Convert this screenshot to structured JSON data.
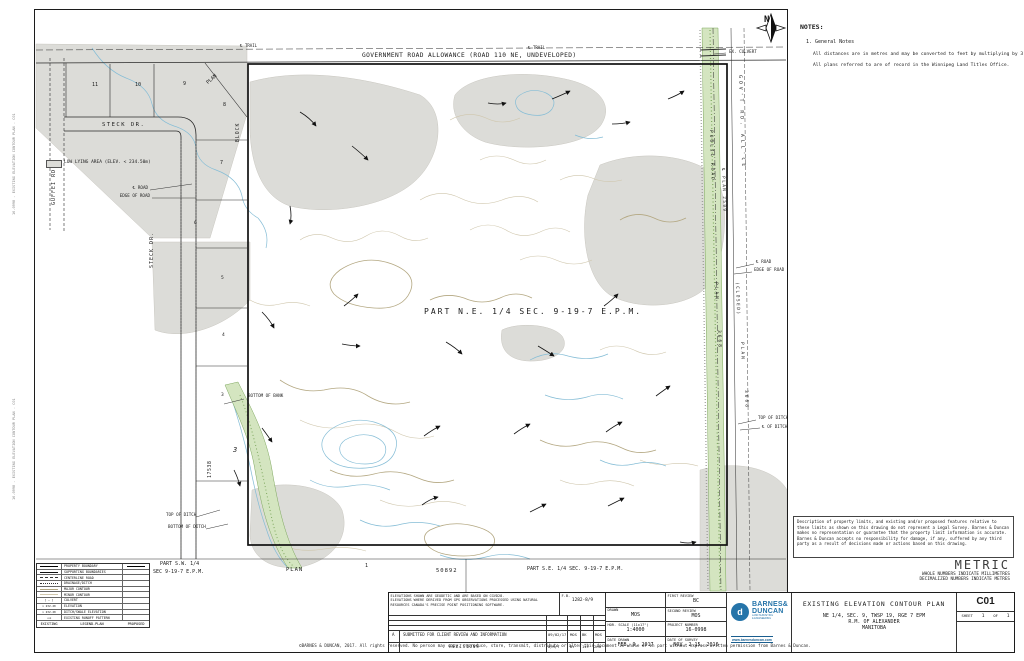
{
  "colors": {
    "contour_major": "#b3a781",
    "contour_minor": "#cfc6ac",
    "water": "#85bdd6",
    "vegetation_fill": "#d4e5c0",
    "vegetation_stroke": "#7da75d",
    "low_lying_fill": "#dcdcd8",
    "logo_blue": "#2574a9"
  },
  "side_stamp": "16-0998 - EXISTING ELEVATION CONTOUR PLAN - C01",
  "notes_panel": {
    "heading": "NOTES:",
    "item1": "1.  General Notes",
    "line1": "All distances are in metres and may be converted to feet by multiplying by 3.28084.",
    "line2": "All plans referred to are of record in the Winnipeg Land Titles Office."
  },
  "map": {
    "top": {
      "trail1": "℄ TRAIL",
      "trail2": "℄ TRAIL",
      "road_allowance": "GOVERNMENT ROAD ALLOWANCE (ROAD 110 NE, UNDEVELOPED)",
      "ex_culvert": "EX. CULVERT",
      "north": "N"
    },
    "subdivision": {
      "guffei_rd": "GUFFEI RD.",
      "steck_dr_h": "STECK DR.",
      "steck_dr_v": "STECK DR.",
      "plan_diag": "PLAN",
      "block": "BLOCK",
      "block_no": "3",
      "plan_17538": "17538",
      "lots_top": [
        "11",
        "10",
        "9",
        "8",
        "7"
      ],
      "lots_left": [
        "6",
        "5",
        "4",
        "3"
      ],
      "low_lying_label": "LOW LYING AREA (ELEV. < 234.50m)"
    },
    "callouts": {
      "cl_road_l": "℄ ROAD",
      "edge_of_road_l": "EDGE OF ROAD",
      "cl_road_r": "℄ ROAD",
      "edge_of_road_r": "EDGE OF ROAD",
      "bottom_of_bank": "BOTTOM OF BANK",
      "top_of_ditch_l": "TOP OF DITCH",
      "bottom_of_ditch_l": "BOTTOM OF DITCH",
      "top_of_ditch_r": "TOP OF DITCH",
      "cl_of_ditch_r": "℄ OF DITCH"
    },
    "parcel_label": "PART  N.E.  1/4  SEC.  9-19-7  E.P.M.",
    "corridor": {
      "public_road": "PUBLIC ROAD",
      "plan_2509": "℄ PLAN 2509",
      "govt_rd_allce": "GOV'T RD. ALL'CE",
      "closed": "(CLOSED)",
      "plan_a": "PLAN",
      "n3668_a": "3668",
      "plan_b": "PLAN",
      "n3668_b": "3668"
    },
    "bottom": {
      "part_sw1": "PART  S.W.  1/4",
      "part_sw2": "SEC  9-19-7  E.P.M.",
      "plan": "PLAN",
      "lot1": "1",
      "plan_no": "50892",
      "part_se": "PART  S.E.  1/4  SEC.  9-19-7  E.P.M."
    }
  },
  "disclaimer": "Description of property limits, and existing and/or proposed features relative to these limits as shown on this drawing do not represent a Legal Survey. Barnes & Duncan makes no representation or guarantee that the property limit information is accurate. Barnes & Duncan accepts no responsibility for damage, if any, suffered by any third party as a result of decisions made or actions based on this drawing.",
  "metric": {
    "title": "METRIC",
    "line1": "WHOLE NUMBERS INDICATE MILLIMETRES",
    "line2": "DECIMALIZED NUMBERS INDICATE METRES"
  },
  "legend": {
    "header": {
      "existing": "EXISTING",
      "title": "LEGEND-PLAN",
      "proposed": "PROPOSED"
    },
    "rows": [
      {
        "label": "PROPERTY BOUNDARY"
      },
      {
        "label": "SUPPORTING BOUNDARIES"
      },
      {
        "label": "CENTERLINE ROAD"
      },
      {
        "label": "DRAINAGE/DITCH"
      },
      {
        "label": "MAJOR CONTOUR"
      },
      {
        "label": "MINOR CONTOUR"
      },
      {
        "label": "CULVERT",
        "symbol_text": "[ — ]"
      },
      {
        "label": "ELEVATION",
        "symbol_text": "× 232.20"
      },
      {
        "label": "DITCH/SWALE ELEVATION",
        "symbol_text": "× 232.20"
      },
      {
        "label": "EXISTING RUNOFF PATTERN",
        "symbol_text": "⟿"
      }
    ]
  },
  "titleblock": {
    "notes_line1": "ELEVATIONS SHOWN ARE GEODETIC AND ARE BASED ON CGVD28.",
    "notes_line2": "ELEVATIONS WHERE DERIVED FROM GPS OBSERVATIONS PROCESSED USING NATURAL",
    "notes_line3": "RESOURCES CANADA'S PRECISE POINT POSITIONING SOFTWARE.",
    "fb_label": "F.B.",
    "fb_value": "1282-8/9",
    "revision": {
      "rev": "A",
      "desc": "SUBMITTED FOR CLIENT REVIEW AND INFORMATION",
      "date": "09/02/17",
      "by": "MOS",
      "first": "BK",
      "second": "MOS"
    },
    "revisions_footer": {
      "title": "REVISIONS",
      "date": "D/M/Y",
      "by": "BY",
      "first": "1st",
      "second": "2nd"
    },
    "drawn_label": "DRAWN",
    "drawn": "MOS",
    "scale_label": "HOR. SCALE (11x17\")",
    "scale": "1:4000",
    "date_drawn_label": "DATE DRAWN",
    "date_drawn": "FEB. 9, 2017",
    "first_review_label": "FIRST REVIEW",
    "first_review": "BC",
    "second_review_label": "SECOND REVIEW",
    "second_review": "MOS",
    "project_label": "PROJECT NUMBER",
    "project": "16-0998",
    "survey_label": "DATE OF SURVEY",
    "survey": "NOV. 2-15, 2016",
    "logo": {
      "name1": "BARNES&",
      "name2": "DUNCAN",
      "tag1": "LAND SURVEYING",
      "tag2": "& ENGINEERING",
      "url": "www.barnesduncan.com"
    },
    "title": "EXISTING ELEVATION CONTOUR PLAN",
    "subtitle1": "NE 1/4, SEC. 9, TWSP 19, RGE 7 EPM",
    "subtitle2": "R.M. OF ALEXANDER",
    "subtitle3": "MANITOBA",
    "sheet_number": "C01",
    "sheet_label": "SHEET",
    "sheet_page": "1",
    "sheet_of": "OF",
    "sheet_total": "1"
  },
  "copyright": "©BARNES & DUNCAN, 2017.  All rights reserved.  No person may copy, reproduce, store, transmit, distribute or alter this document in whole or in part without express written permission from Barnes & Duncan."
}
